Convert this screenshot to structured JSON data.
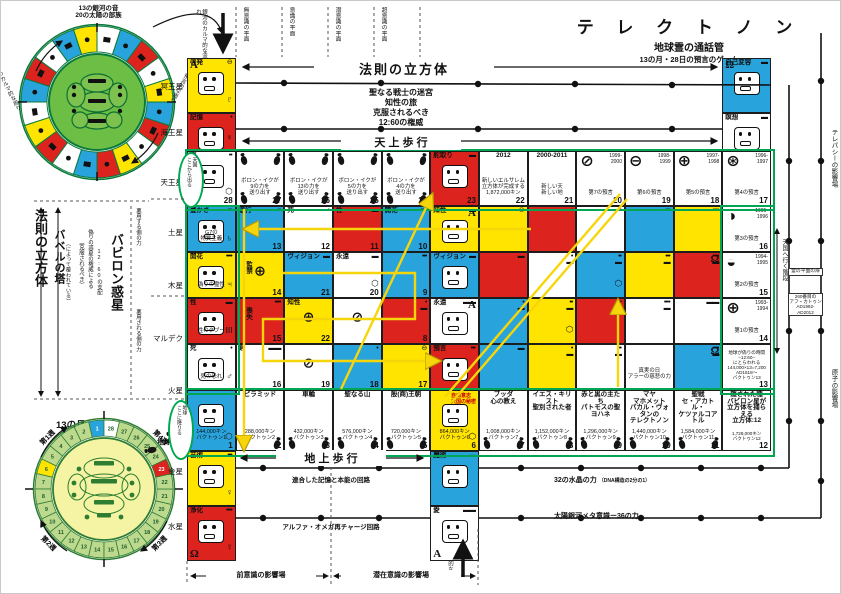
{
  "title": {
    "main": "テ レ ク ト ノ ン",
    "sub1": "地球霊の通話管",
    "sub2": "13の月・28日の預言のゲーム"
  },
  "upper_wheel": {
    "caption": "13の銀河の音\n20の太陽の部族",
    "left_arc_label": "銀河のカルマ的な周り",
    "right_arc_label": "太陽の預言的な周り",
    "ring_colors": [
      "#ffe400",
      "#29a3dc",
      "#ffffff",
      "#dc231e",
      "#29a3dc",
      "#ffffff",
      "#ffe400",
      "#dc231e",
      "#ffffff",
      "#29a3dc",
      "#dc231e",
      "#ffe400",
      "#ffffff",
      "#dc231e",
      "#29a3dc",
      "#ffe400",
      "#ffffff",
      "#dc231e",
      "#29a3dc",
      "#ffffff"
    ]
  },
  "lower_wheel": {
    "caption": "13の月・28日",
    "subcaption": "プラス1日の自由の日",
    "weeks": [
      "第1週",
      "第2週",
      "第3週",
      "第4週"
    ],
    "earth": "地球",
    "days": 28,
    "special_colors": {
      "1": "#29a3dc",
      "6": "#ffe400",
      "23": "#dc231e",
      "28": "#ffffff"
    },
    "default_color": "#bcd98e"
  },
  "planets": [
    "冥王星",
    "海王星",
    "天王星",
    "土星",
    "木星",
    "マルデク",
    "火星",
    "金星",
    "水星"
  ],
  "planes": [
    "無意識の平面",
    "意識の平面",
    "潜意識の平面",
    "超意識の平面"
  ],
  "karmic_flow": "銀河のカルマ的な流れ",
  "left_labels": {
    "cube": "法則の立方体",
    "babel": "バベルの塔",
    "babel_note": "（によって覆われている）",
    "rule1": "（克服されるべき）",
    "rule2": "偽りの惑星の権威による",
    "rule3": "12:60の支配",
    "babylon": "バビロン惑星",
    "misuse_upper": "悪用する側の力",
    "misuse_lower": "悪用される側の力"
  },
  "header": {
    "cube_arrow": "法則の立方体",
    "warrior": "聖なる戦士の迷宮\n知性の旅\n克服されるべき\n12:60の権威",
    "heaven_walk": "天 上 歩 行",
    "earth_walk": "地 上 歩 行",
    "memory_circuit": "連合した記憶と本能の回路",
    "recharge_circuit": "アルファ・オメガ再チャージ回路",
    "crystal": "32の水晶の力",
    "crystal_note": "（DNA構造の2分の1）",
    "metacon": "太陽銀河メタ意識ー36の力"
  },
  "right_edge": {
    "telepathy": "テレパシーの影響場",
    "atom": "原子の影響場",
    "stairs": "天国へ行く階段",
    "door": "霊の平面の扉",
    "katun": "260番目の\nアフ・カトゥン",
    "katun_years": "AD1992-\nAD2012"
  },
  "influence": {
    "pre": "前意識の影響場",
    "sub": "潜在意識の影響場",
    "solar_flow": "太陽の預言的な流れ"
  },
  "ovals": {
    "top": "天国\nここから出る",
    "bottom": "地球\nここに降りる"
  },
  "solo_cells": {
    "keihatsu": {
      "C": "Y",
      "L": "A",
      "Lp": "tl",
      "l": "啓発",
      "m": "⊖",
      "g": 1,
      "p": "♇"
    },
    "kioku": {
      "C": "R",
      "l": "記憶",
      "m": "•",
      "g": 1,
      "p": "♆"
    },
    "jiko": {
      "C": "B",
      "L": "Ω",
      "Lp": "tl",
      "l": "自己変容",
      "m": "▬",
      "g": 1
    },
    "meiso": {
      "C": "W",
      "l": "瞑想",
      "m": "▬",
      "g": 1
    },
    "geijutsu": {
      "C": "Y",
      "l": "芸術",
      "m": "•••",
      "g": 1,
      "p": "♀"
    },
    "joka": {
      "C": "R",
      "l": "浄化",
      "m": "••••",
      "g": 1,
      "L": "Ω",
      "Lp": "bl",
      "p": "☿"
    },
    "majutsu": {
      "C": "B",
      "l": "魔術",
      "m": "▬",
      "g": 1
    },
    "ai": {
      "C": "W",
      "l": "愛",
      "m": "▬▬",
      "g": 1,
      "L": "A",
      "Lp": "bl"
    }
  },
  "grid": {
    "rows": [
      [
        {
          "C": "W",
          "l": "壷",
          "m": "••",
          "g": 1,
          "p": "⬡",
          "n": "28"
        },
        {
          "C": "W",
          "s": "ボロン・イクが\n9の力を\n送り出す",
          "n": "27",
          "f": 2
        },
        {
          "C": "W",
          "s": "ボロン・イクが\n13の力を\n送り出す",
          "n": "26",
          "f": 2
        },
        {
          "C": "W",
          "s": "ボロン・イクが\n5の力を\n送り出す",
          "n": "25",
          "f": 2
        },
        {
          "C": "W",
          "s": "ボロン・イクが\n4の力を\n送り出す",
          "n": "24",
          "f": 2
        },
        {
          "C": "R",
          "l": "舵取り",
          "g": 1,
          "m": "▬",
          "n": "23"
        },
        {
          "C": "W",
          "ctr": 1,
          "l": "2012",
          "s": "新しいエルサレム\n立方体が完成する\n1,872,000キン",
          "n": "22"
        },
        {
          "C": "W",
          "ctr": 1,
          "l": "2000-2011",
          "s": "新しい天\n新しい地",
          "n": "21"
        },
        {
          "C": "W",
          "w": "⊘",
          "y": "1999-\n2000",
          "s": "第7の預言",
          "n": "20"
        },
        {
          "C": "W",
          "w": "⊖",
          "y": "1998-\n1999",
          "s": "第6の預言",
          "n": "19"
        },
        {
          "C": "W",
          "w": "⊕",
          "y": "1997-\n1998",
          "s": "第5の預言",
          "n": "18"
        },
        {
          "C": "W",
          "w": "⊛",
          "y": "1996-\n1997",
          "s": "第4の預言",
          "n": "17"
        }
      ],
      [
        {
          "C": "B",
          "l": "豊かさ",
          "m": "•••",
          "g": 1,
          "s": "G7の\n物質主義",
          "p": "♄"
        },
        {
          "C": "B",
          "l": "遂行",
          "m": "••",
          "n": "13"
        },
        {
          "C": "W",
          "l": "死",
          "m": "•",
          "n": "12"
        },
        {
          "C": "R",
          "l": "性",
          "m": "▬",
          "n": "11"
        },
        {
          "C": "B",
          "l": "開花",
          "m": "••••",
          "n": "10"
        },
        {
          "C": "Y",
          "l": "知性",
          "m": "▬",
          "g": 1,
          "L": "A"
        },
        {
          "C": "Y",
          "m": "⊖"
        },
        {
          "C": "R",
          "m": "•"
        },
        {
          "C": "W",
          "m": "••"
        },
        {
          "C": "B",
          "m": "•••"
        },
        {
          "C": "Y",
          "m": "••••"
        },
        {
          "C": "W",
          "w": "◑",
          "y": "1995-\n1996",
          "s": "第3の預言",
          "n": "16"
        }
      ],
      [
        {
          "C": "Y",
          "l": "開花",
          "m": "••••",
          "g": 1,
          "s": "偽りの霊性",
          "p": "♃"
        },
        {
          "C": "Y",
          "vl": "監禁",
          "w2": "⊕",
          "n": "14"
        },
        {
          "C": "B",
          "l": "ヴィジョン",
          "m": "▬",
          "n": "21"
        },
        {
          "C": "W",
          "l": "永遠",
          "m": "▬",
          "p": "⬡",
          "n": "20"
        },
        {
          "C": "B",
          "m": "•••",
          "n": "9"
        },
        {
          "C": "B",
          "l": "ヴィジョン",
          "m": "▬",
          "g": 1
        },
        {
          "C": "R",
          "m": "▬"
        },
        {
          "C": "W",
          "m": "•\n▬"
        },
        {
          "C": "B",
          "m": "••\n▬",
          "p": "⬡"
        },
        {
          "C": "Y",
          "m": "•••\n▬"
        },
        {
          "C": "R",
          "m": "••••\n▬",
          "L": "Ω"
        },
        {
          "C": "W",
          "w": "◒",
          "y": "1994-\n1995",
          "s": "第2の預言",
          "n": "15"
        }
      ],
      [
        {
          "C": "R",
          "l": "性",
          "m": "▬",
          "g": 1,
          "s": "性のタブー",
          "p": "ΙΙΙ"
        },
        {
          "C": "R",
          "vl": "喪失",
          "m": "••••",
          "n": "15"
        },
        {
          "C": "Y",
          "l": "知性",
          "w2": "⊕",
          "n": "22"
        },
        {
          "C": "W",
          "w2": "⊘"
        },
        {
          "C": "R",
          "m": "•\n▬",
          "n": "8"
        },
        {
          "C": "W",
          "l": "永遠",
          "m": "▬▬",
          "g": 1,
          "L": "A"
        },
        {
          "C": "B",
          "m": "•\n▬"
        },
        {
          "C": "Y",
          "m": "••\n▬",
          "p": "⬡"
        },
        {
          "C": "R",
          "m": "•••\n▬"
        },
        {
          "C": "W",
          "m": "••••\n▬"
        },
        {
          "C": "W",
          "m": "▬▬"
        },
        {
          "C": "W",
          "w": "⊕",
          "y": "1993-\n1994",
          "s": "第1の預言",
          "n": "14"
        }
      ],
      [
        {
          "C": "W",
          "l": "死",
          "m": "•",
          "g": 1,
          "s": "死の恐れ",
          "p": "♂"
        },
        {
          "C": "W",
          "l": "剣",
          "m": "▬▬",
          "n": "16"
        },
        {
          "C": "W",
          "w2": "⊘",
          "n": "19"
        },
        {
          "C": "B",
          "m": "•",
          "n": "18"
        },
        {
          "C": "Y",
          "m": "⊖",
          "n": "17"
        },
        {
          "C": "R",
          "l": "預言",
          "m": "•••",
          "g": 1
        },
        {
          "C": "B",
          "m": "▬"
        },
        {
          "C": "Y",
          "m": "•\n▬"
        },
        {
          "C": "W",
          "m": "••\n▬"
        },
        {
          "C": "W",
          "s": "真実の日\nアラーの慈悲の力"
        },
        {
          "C": "B",
          "m": "••••\n▬",
          "L": "Ω"
        },
        {
          "C": "W",
          "tiny": 1,
          "s": "地球が偽りの時間\n−12:60−\nにとらわれる\n144,000×13=7,200\nAD1618〜\nバクトゥン13",
          "n": "13"
        }
      ],
      [
        {
          "C": "B",
          "g": 1,
          "p": "⬡",
          "s": "144,000キン\nバクトゥン1",
          "n": "1"
        },
        {
          "C": "W",
          "ctr": 1,
          "l": "ピラミッド",
          "s": "288,000キン\nバクトゥン2",
          "n": "2",
          "f": 1
        },
        {
          "C": "W",
          "ctr": 1,
          "l": "車輪",
          "s": "432,000キン\nバクトゥン3",
          "n": "3",
          "f": 1
        },
        {
          "C": "W",
          "ctr": 1,
          "l": "聖なる山",
          "s": "576,000キン\nバクトゥン4",
          "n": "4",
          "f": 1
        },
        {
          "C": "W",
          "ctr": 1,
          "l": "殷(商)王朝",
          "s": "720,000キン\nバクトゥン5",
          "n": "5",
          "f": 1
        },
        {
          "C": "Y",
          "g": 1,
          "p": "⬡",
          "rs": "自由意志\n天国の秘密",
          "s": "864,000キン\nバクトゥン6",
          "n": "6"
        },
        {
          "C": "W",
          "ctr": 1,
          "l": "ブッダ\n心の教え",
          "s": "1,008,000キン\nバクトゥン7",
          "n": "7",
          "f": 1
        },
        {
          "C": "W",
          "ctr": 1,
          "l": "イエス・キリスト\n聖別された者",
          "s": "1,152,000キン\nバクトゥン8",
          "n": "8",
          "f": 1
        },
        {
          "C": "W",
          "ctr": 1,
          "l": "赤と黒の主たち\nパトモスの聖ヨハネ",
          "s": "1,296,000キン\nバクトゥン9",
          "n": "9",
          "f": 1
        },
        {
          "C": "W",
          "ctr": 1,
          "l": "マヤ\nマホメット\nパカル・ヴォタンの\nテレクトノン",
          "s": "1,440,000キン\nバクトゥン10",
          "n": "10",
          "f": 1
        },
        {
          "C": "W",
          "ctr": 1,
          "l": "聖戦\nセ・アカトル・\nケツァルコアトル",
          "s": "1,584,000キン\nバクトゥン11",
          "n": "11",
          "f": 1
        },
        {
          "C": "W",
          "ctr": 1,
          "tiny": 1,
          "l": "隠された種\nバビロン星が\n立方体を捕らえる\n立方体:12",
          "s": "1,728,000キン\nバクトゥン12",
          "n": "12"
        }
      ]
    ]
  }
}
